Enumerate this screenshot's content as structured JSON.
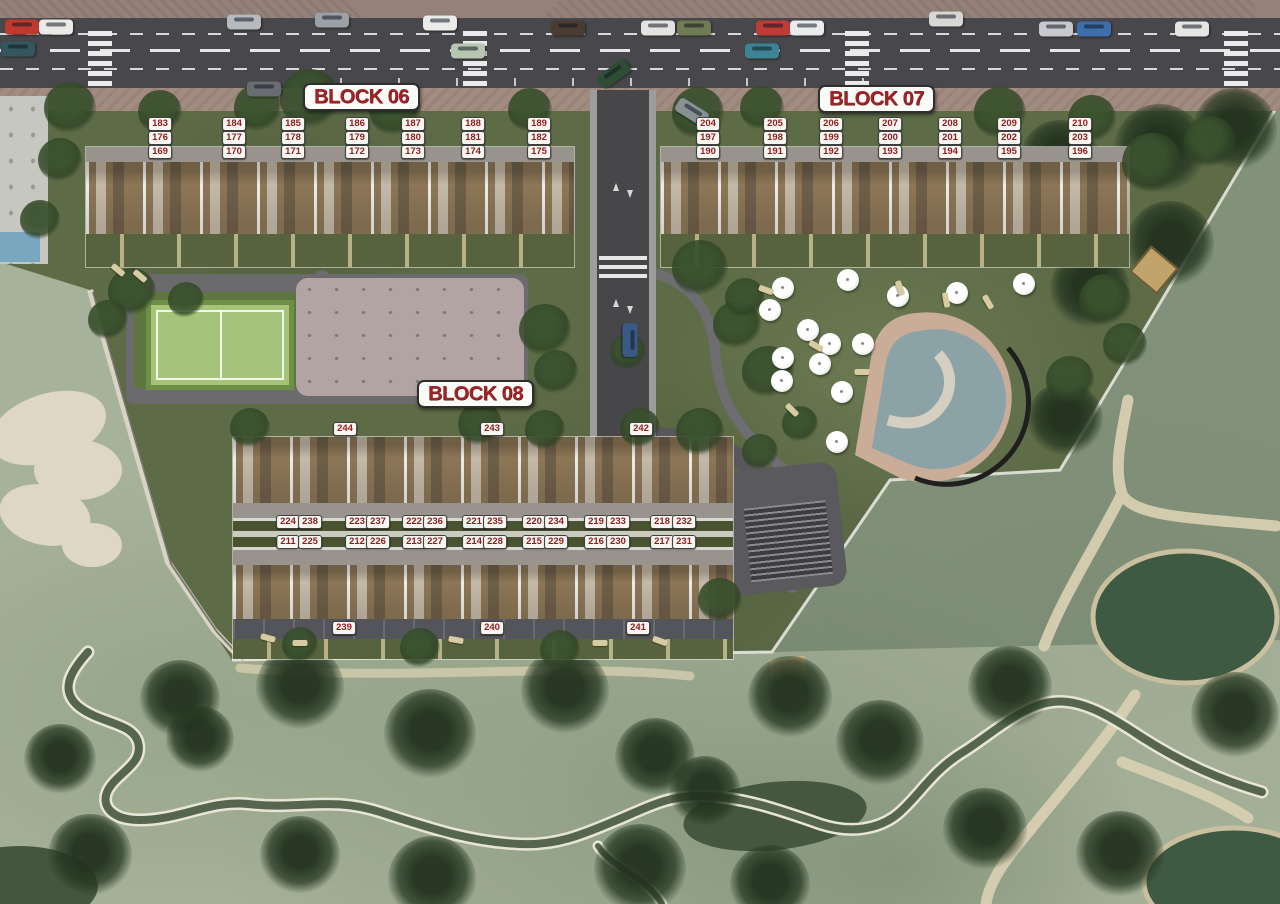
{
  "palette": {
    "label_red": "#9e2428",
    "chip_text": "#8e1f21",
    "chip_bg": "#f8f6f1",
    "road_asphalt": "#48484c",
    "sidewalk": "#94817a",
    "development_green": "#5d6b47",
    "golf_green": "#a7b29a",
    "deck_wood": "#8c7656",
    "court_green": "#a6c479",
    "pool_water": "#8ba2a6",
    "pool_deck": "#c9ad99",
    "sand_bunker": "#ded7c3",
    "pond": "#3f5a42"
  },
  "blocks": [
    {
      "id": "06",
      "label": "BLOCK 06",
      "label_box": {
        "x": 303,
        "y": 83
      },
      "units": [
        {
          "n": "183",
          "x": 160,
          "y": 124
        },
        {
          "n": "184",
          "x": 234,
          "y": 124
        },
        {
          "n": "185",
          "x": 293,
          "y": 124
        },
        {
          "n": "186",
          "x": 357,
          "y": 124
        },
        {
          "n": "187",
          "x": 413,
          "y": 124
        },
        {
          "n": "188",
          "x": 473,
          "y": 124
        },
        {
          "n": "189",
          "x": 539,
          "y": 124
        },
        {
          "n": "176",
          "x": 160,
          "y": 138
        },
        {
          "n": "177",
          "x": 234,
          "y": 138
        },
        {
          "n": "178",
          "x": 293,
          "y": 138
        },
        {
          "n": "179",
          "x": 357,
          "y": 138
        },
        {
          "n": "180",
          "x": 413,
          "y": 138
        },
        {
          "n": "181",
          "x": 473,
          "y": 138
        },
        {
          "n": "182",
          "x": 539,
          "y": 138
        },
        {
          "n": "169",
          "x": 160,
          "y": 152
        },
        {
          "n": "170",
          "x": 234,
          "y": 152
        },
        {
          "n": "171",
          "x": 293,
          "y": 152
        },
        {
          "n": "172",
          "x": 357,
          "y": 152
        },
        {
          "n": "173",
          "x": 413,
          "y": 152
        },
        {
          "n": "174",
          "x": 473,
          "y": 152
        },
        {
          "n": "175",
          "x": 539,
          "y": 152
        }
      ]
    },
    {
      "id": "07",
      "label": "BLOCK 07",
      "label_box": {
        "x": 818,
        "y": 85
      },
      "units": [
        {
          "n": "204",
          "x": 708,
          "y": 124
        },
        {
          "n": "205",
          "x": 775,
          "y": 124
        },
        {
          "n": "206",
          "x": 831,
          "y": 124
        },
        {
          "n": "207",
          "x": 890,
          "y": 124
        },
        {
          "n": "208",
          "x": 950,
          "y": 124
        },
        {
          "n": "209",
          "x": 1009,
          "y": 124
        },
        {
          "n": "210",
          "x": 1080,
          "y": 124
        },
        {
          "n": "197",
          "x": 708,
          "y": 138
        },
        {
          "n": "198",
          "x": 775,
          "y": 138
        },
        {
          "n": "199",
          "x": 831,
          "y": 138
        },
        {
          "n": "200",
          "x": 890,
          "y": 138
        },
        {
          "n": "201",
          "x": 950,
          "y": 138
        },
        {
          "n": "202",
          "x": 1009,
          "y": 138
        },
        {
          "n": "203",
          "x": 1080,
          "y": 138
        },
        {
          "n": "190",
          "x": 708,
          "y": 152
        },
        {
          "n": "191",
          "x": 775,
          "y": 152
        },
        {
          "n": "192",
          "x": 831,
          "y": 152
        },
        {
          "n": "193",
          "x": 890,
          "y": 152
        },
        {
          "n": "194",
          "x": 950,
          "y": 152
        },
        {
          "n": "195",
          "x": 1009,
          "y": 152
        },
        {
          "n": "196",
          "x": 1080,
          "y": 152
        }
      ]
    },
    {
      "id": "08",
      "label": "BLOCK 08",
      "label_box": {
        "x": 417,
        "y": 380
      },
      "units": [
        {
          "n": "244",
          "x": 345,
          "y": 429
        },
        {
          "n": "243",
          "x": 492,
          "y": 429
        },
        {
          "n": "242",
          "x": 641,
          "y": 429
        },
        {
          "n": "224",
          "x": 288,
          "y": 522
        },
        {
          "n": "238",
          "x": 310,
          "y": 522
        },
        {
          "n": "223",
          "x": 357,
          "y": 522
        },
        {
          "n": "237",
          "x": 378,
          "y": 522
        },
        {
          "n": "222",
          "x": 414,
          "y": 522
        },
        {
          "n": "236",
          "x": 435,
          "y": 522
        },
        {
          "n": "221",
          "x": 474,
          "y": 522
        },
        {
          "n": "235",
          "x": 495,
          "y": 522
        },
        {
          "n": "220",
          "x": 534,
          "y": 522
        },
        {
          "n": "234",
          "x": 556,
          "y": 522
        },
        {
          "n": "219",
          "x": 596,
          "y": 522
        },
        {
          "n": "233",
          "x": 618,
          "y": 522
        },
        {
          "n": "218",
          "x": 662,
          "y": 522
        },
        {
          "n": "232",
          "x": 684,
          "y": 522
        },
        {
          "n": "211",
          "x": 288,
          "y": 542
        },
        {
          "n": "225",
          "x": 310,
          "y": 542
        },
        {
          "n": "212",
          "x": 357,
          "y": 542
        },
        {
          "n": "226",
          "x": 378,
          "y": 542
        },
        {
          "n": "213",
          "x": 414,
          "y": 542
        },
        {
          "n": "227",
          "x": 435,
          "y": 542
        },
        {
          "n": "214",
          "x": 474,
          "y": 542
        },
        {
          "n": "228",
          "x": 495,
          "y": 542
        },
        {
          "n": "215",
          "x": 534,
          "y": 542
        },
        {
          "n": "229",
          "x": 556,
          "y": 542
        },
        {
          "n": "216",
          "x": 596,
          "y": 542
        },
        {
          "n": "230",
          "x": 618,
          "y": 542
        },
        {
          "n": "217",
          "x": 662,
          "y": 542
        },
        {
          "n": "231",
          "x": 684,
          "y": 542
        },
        {
          "n": "239",
          "x": 344,
          "y": 628
        },
        {
          "n": "240",
          "x": 492,
          "y": 628
        },
        {
          "n": "241",
          "x": 638,
          "y": 628
        }
      ]
    }
  ],
  "scenery": {
    "cars": [
      {
        "x": 22,
        "y": 27,
        "r": 0,
        "c": "#c0392f"
      },
      {
        "x": 56,
        "y": 27,
        "r": 0,
        "c": "#eceae6"
      },
      {
        "x": 244,
        "y": 22,
        "r": 0,
        "c": "#b6b9bd"
      },
      {
        "x": 332,
        "y": 20,
        "r": 0,
        "c": "#9aa0a6"
      },
      {
        "x": 440,
        "y": 23,
        "r": 0,
        "c": "#ebebe9"
      },
      {
        "x": 568,
        "y": 28,
        "r": 0,
        "c": "#4b3c31"
      },
      {
        "x": 658,
        "y": 28,
        "r": 0,
        "c": "#e3e3e1"
      },
      {
        "x": 694,
        "y": 28,
        "r": 0,
        "c": "#6f7b52"
      },
      {
        "x": 773,
        "y": 28,
        "r": 0,
        "c": "#bf3b36"
      },
      {
        "x": 807,
        "y": 28,
        "r": 0,
        "c": "#ebebeb"
      },
      {
        "x": 946,
        "y": 19,
        "r": 0,
        "c": "#d7d7d5"
      },
      {
        "x": 1056,
        "y": 29,
        "r": 0,
        "c": "#c7c9cc"
      },
      {
        "x": 1094,
        "y": 29,
        "r": 0,
        "c": "#3e6eab"
      },
      {
        "x": 1192,
        "y": 29,
        "r": 0,
        "c": "#e5e5e3"
      },
      {
        "x": 468,
        "y": 51,
        "r": 0,
        "c": "#b7c6b0"
      },
      {
        "x": 762,
        "y": 51,
        "r": 0,
        "c": "#3c8493"
      },
      {
        "x": 614,
        "y": 74,
        "r": -35,
        "c": "#2d4e34"
      },
      {
        "x": 18,
        "y": 49,
        "r": 0,
        "c": "#34575d"
      },
      {
        "x": 264,
        "y": 89,
        "r": 0,
        "c": "#696c71"
      },
      {
        "x": 692,
        "y": 112,
        "r": 32,
        "c": "#889094"
      },
      {
        "x": 630,
        "y": 340,
        "r": 90,
        "c": "#3a5a88"
      }
    ],
    "umbrellas": [
      [
        783,
        288
      ],
      [
        848,
        280
      ],
      [
        898,
        296
      ],
      [
        957,
        293
      ],
      [
        1024,
        284
      ],
      [
        770,
        310
      ],
      [
        808,
        330
      ],
      [
        830,
        344
      ],
      [
        863,
        344
      ],
      [
        783,
        358
      ],
      [
        820,
        364
      ],
      [
        782,
        381
      ],
      [
        842,
        392
      ],
      [
        837,
        442
      ]
    ],
    "loungers": [
      [
        766,
        290,
        20
      ],
      [
        900,
        288,
        70
      ],
      [
        946,
        300,
        80
      ],
      [
        988,
        302,
        60
      ],
      [
        816,
        346,
        30
      ],
      [
        862,
        372,
        0
      ],
      [
        792,
        410,
        45
      ],
      [
        268,
        638,
        15
      ],
      [
        300,
        643,
        0
      ],
      [
        456,
        640,
        10
      ],
      [
        600,
        643,
        0
      ],
      [
        660,
        641,
        20
      ],
      [
        118,
        270,
        40
      ],
      [
        140,
        276,
        40
      ]
    ],
    "trees": [
      [
        70,
        108,
        26
      ],
      [
        160,
        112,
        22
      ],
      [
        258,
        108,
        24
      ],
      [
        310,
        99,
        30
      ],
      [
        395,
        110,
        26
      ],
      [
        530,
        110,
        22
      ],
      [
        698,
        113,
        26
      ],
      [
        762,
        108,
        22
      ],
      [
        1000,
        113,
        26
      ],
      [
        1092,
        119,
        24
      ],
      [
        1152,
        163,
        30
      ],
      [
        1210,
        142,
        26
      ],
      [
        545,
        330,
        26
      ],
      [
        556,
        372,
        22
      ],
      [
        700,
        268,
        28
      ],
      [
        737,
        325,
        24
      ],
      [
        768,
        372,
        26
      ],
      [
        700,
        432,
        24
      ],
      [
        628,
        352,
        18
      ],
      [
        545,
        430,
        20
      ],
      [
        480,
        424,
        22
      ],
      [
        250,
        428,
        20
      ],
      [
        640,
        428,
        20
      ],
      [
        132,
        292,
        24
      ],
      [
        108,
        320,
        20
      ],
      [
        186,
        300,
        18
      ],
      [
        60,
        160,
        22
      ],
      [
        40,
        220,
        20
      ],
      [
        300,
        645,
        18
      ],
      [
        420,
        648,
        20
      ],
      [
        560,
        650,
        20
      ],
      [
        720,
        600,
        22
      ],
      [
        745,
        298,
        20
      ],
      [
        800,
        424,
        18
      ],
      [
        760,
        452,
        18
      ],
      [
        1105,
        300,
        26
      ],
      [
        1070,
        380,
        24
      ],
      [
        1125,
        345,
        22
      ]
    ],
    "palms": [
      [
        180,
        700,
        40
      ],
      [
        300,
        688,
        44
      ],
      [
        430,
        735,
        46
      ],
      [
        565,
        692,
        44
      ],
      [
        655,
        758,
        40
      ],
      [
        705,
        792,
        36
      ],
      [
        790,
        698,
        42
      ],
      [
        880,
        744,
        44
      ],
      [
        1010,
        688,
        42
      ],
      [
        1235,
        716,
        44
      ],
      [
        90,
        856,
        42
      ],
      [
        300,
        856,
        40
      ],
      [
        432,
        880,
        44
      ],
      [
        640,
        870,
        46
      ],
      [
        985,
        830,
        42
      ],
      [
        1120,
        855,
        44
      ],
      [
        770,
        885,
        40
      ],
      [
        1060,
        160,
        40
      ],
      [
        1160,
        150,
        46
      ],
      [
        1235,
        130,
        42
      ],
      [
        1090,
        290,
        40
      ],
      [
        1170,
        245,
        44
      ],
      [
        1065,
        420,
        38
      ],
      [
        200,
        740,
        34
      ],
      [
        60,
        760,
        36
      ]
    ]
  }
}
